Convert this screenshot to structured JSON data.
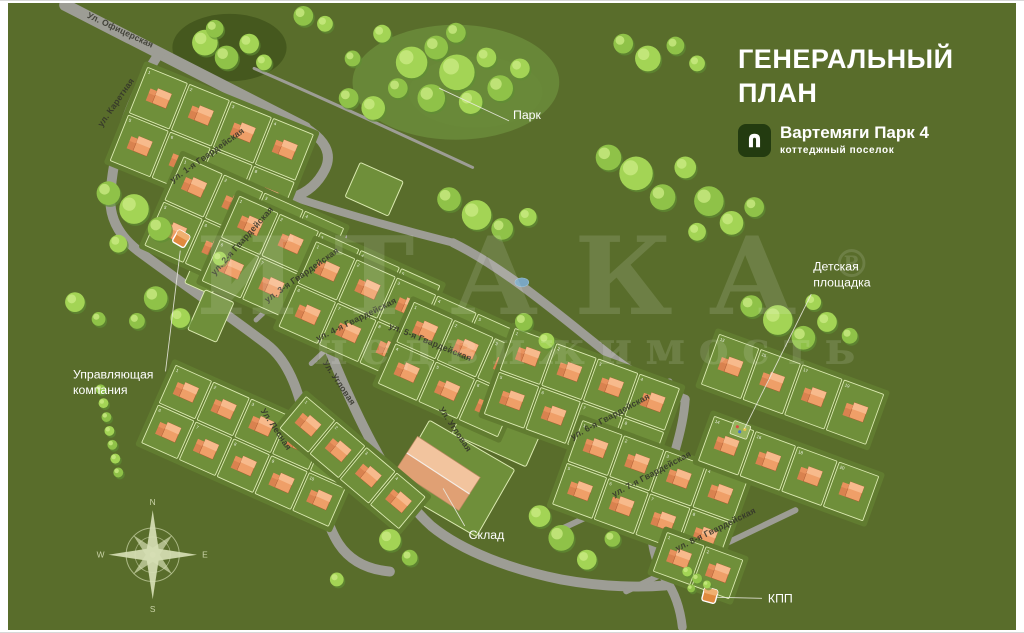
{
  "title": {
    "line1": "ГЕНЕРАЛЬНЫЙ",
    "line2": "ПЛАН"
  },
  "brand": {
    "name": "Вартемяги Парк 4",
    "subtitle": "коттеджный поселок",
    "logo_icon": "house-icon"
  },
  "watermark": {
    "line1": "ИТАКА",
    "reg": "®",
    "line2": "недвижимость"
  },
  "colors": {
    "bg": "#596d2b",
    "plate": "#617c30",
    "parcel": "#6f8f3a",
    "parcelStroke": "#dcebb2",
    "road": "#9d9d95",
    "houseBody": "#ef9f68",
    "houseWing": "#d9824f",
    "houseTop": "#f7ba8c",
    "wingTop": "#e8925d",
    "houseOutline": "#a5542e",
    "treeDark": "#5f8f33",
    "tree1": "#8fc248",
    "tree2": "#a3d455",
    "treeHi": "#c9ea82",
    "label": "#33332a",
    "callout": "#ffffff",
    "leader": "#e9e9df",
    "compass": "#d6deb4",
    "parkPatch": "#69893a",
    "darkPatch": "#42551d",
    "pond": "#7aa6c2",
    "marker": "#e08a3f",
    "warehouseFront": "#f2c49e",
    "warehouseBack": "#e0a074"
  },
  "map": {
    "patches": [
      [
        225,
        45,
        58,
        34,
        "dark"
      ],
      [
        455,
        80,
        105,
        58,
        "park"
      ],
      [
        475,
        90,
        68,
        36,
        "park"
      ]
    ],
    "roads": [
      {
        "d": "M58,2 L302,126",
        "w": 12
      },
      {
        "d": "M302,126 C322,138 330,152 322,168 C314,184 302,192 290,196",
        "w": 10
      },
      {
        "d": "M154,50 C126,92 106,148 104,196 C103,218 114,236 132,250 C170,278 222,314 262,344",
        "w": 10
      },
      {
        "d": "M262,344 C292,366 300,410 310,462 C316,498 324,528 336,546 C348,564 366,572 388,574",
        "w": 10
      },
      {
        "d": "M290,196 C340,212 396,228 452,242",
        "w": 8
      },
      {
        "d": "M452,242 C505,268 560,315 612,356 C646,382 668,392 688,400",
        "w": 9
      },
      {
        "d": "M688,400 C686,432 672,472 658,508 C650,532 654,558 668,582 C678,596 683,612 685,630",
        "w": 9
      },
      {
        "d": "M290,196 C288,228 292,262 306,296 C318,330 344,398 374,452 C392,486 410,510 430,528 C462,554 512,572 562,582 C606,590 644,590 668,588",
        "w": 10
      },
      {
        "d": "M162,192 L258,118",
        "w": 7
      },
      {
        "d": "M252,320 L342,236",
        "w": 5
      },
      {
        "d": "M308,364 L400,278",
        "w": 5
      },
      {
        "d": "M500,452 L672,382",
        "w": 6
      },
      {
        "d": "M560,532 L732,452",
        "w": 6
      },
      {
        "d": "M628,594 L800,512",
        "w": 6
      },
      {
        "d": "M250,66 C320,96 420,142 472,166",
        "w": 3
      }
    ],
    "blocks": [
      {
        "id": "A",
        "cx": 207,
        "cy": 146,
        "rot": 22,
        "nx": 4,
        "ny": 2,
        "cw": 46,
        "ch": 52
      },
      {
        "id": "B",
        "cx": 240,
        "cy": 236,
        "rot": 24,
        "nx": 4,
        "ny": 2,
        "cw": 45,
        "ch": 50
      },
      {
        "id": "C",
        "cx": 318,
        "cy": 283,
        "rot": 24,
        "nx": 5,
        "ny": 2,
        "cw": 45,
        "ch": 48
      },
      {
        "id": "D",
        "cx": 396,
        "cy": 329,
        "rot": 24,
        "nx": 5,
        "ny": 2,
        "cw": 45,
        "ch": 48
      },
      {
        "id": "D2",
        "cx": 455,
        "cy": 370,
        "rot": 24,
        "nx": 3,
        "ny": 2,
        "cw": 45,
        "ch": 46
      },
      {
        "id": "E",
        "cx": 248,
        "cy": 447,
        "rot": 24,
        "nx": 5,
        "ny": 2,
        "cw": 42,
        "ch": 44
      },
      {
        "id": "E2",
        "cx": 350,
        "cy": 464,
        "rot": 40,
        "nx": 4,
        "ny": 1,
        "cw": 40,
        "ch": 44
      },
      {
        "id": "F",
        "cx": 583,
        "cy": 402,
        "rot": 20,
        "nx": 4,
        "ny": 2,
        "cw": 45,
        "ch": 47
      },
      {
        "id": "G",
        "cx": 652,
        "cy": 494,
        "rot": 20,
        "nx": 4,
        "ny": 2,
        "cw": 45,
        "ch": 46
      },
      {
        "id": "FR1",
        "cx": 797,
        "cy": 390,
        "rot": 20,
        "nx": 4,
        "ny": 1,
        "cw": 45,
        "ch": 56,
        "nums": [
          13,
          15,
          17,
          19
        ]
      },
      {
        "id": "FR2",
        "cx": 793,
        "cy": 470,
        "rot": 20,
        "nx": 4,
        "ny": 1,
        "cw": 45,
        "ch": 50,
        "nums": [
          14,
          16,
          18,
          20
        ]
      },
      {
        "id": "BR",
        "cx": 701,
        "cy": 568,
        "rot": 20,
        "nx": 2,
        "ny": 1,
        "cw": 42,
        "ch": 44
      }
    ],
    "empties": [
      {
        "cx": 200,
        "cy": 273,
        "w": 30,
        "h": 34,
        "rot": 24
      },
      {
        "cx": 206,
        "cy": 316,
        "w": 32,
        "h": 44,
        "rot": 24
      },
      {
        "cx": 372,
        "cy": 188,
        "w": 48,
        "h": 38,
        "rot": 24
      },
      {
        "cx": 500,
        "cy": 426,
        "w": 82,
        "h": 56,
        "rot": 24
      },
      {
        "cx": 452,
        "cy": 480,
        "w": 100,
        "h": 78,
        "rot": 30
      }
    ],
    "warehouse": {
      "cx": 437,
      "cy": 475,
      "w": 76,
      "h": 40,
      "rot": 33
    },
    "markers": [
      {
        "id": "management-marker",
        "cx": 176,
        "cy": 238,
        "rot": 30
      },
      {
        "id": "kpp-marker",
        "cx": 713,
        "cy": 598,
        "rot": 15
      }
    ],
    "playground": {
      "cx": 744,
      "cy": 431,
      "rot": 20
    },
    "pond": {
      "cx": 522,
      "cy": 282,
      "rx": 7,
      "ry": 4.5
    },
    "streets": [
      {
        "t": "Ул. Офицерская",
        "x": 113,
        "y": 30,
        "r": 25
      },
      {
        "t": "ул. Каретная",
        "x": 112,
        "y": 102,
        "r": -55
      },
      {
        "t": "ул. 1-я Гвардейская",
        "x": 204,
        "y": 156,
        "r": -35
      },
      {
        "t": "ул. 2-я Гвардейская",
        "x": 240,
        "y": 242,
        "r": -48
      },
      {
        "t": "ул. 3-я Гвардейская",
        "x": 300,
        "y": 277,
        "r": -35
      },
      {
        "t": "ул. 4-я Гвардейская",
        "x": 355,
        "y": 322,
        "r": -26
      },
      {
        "t": "ул. 5-я Гвардейская",
        "x": 428,
        "y": 345,
        "r": 22
      },
      {
        "t": "ул. 6-я Гвардейская",
        "x": 613,
        "y": 420,
        "r": -28
      },
      {
        "t": "ул. 7-я Гвардейская",
        "x": 655,
        "y": 478,
        "r": -28
      },
      {
        "t": "ул. 8-я Гвардейская",
        "x": 720,
        "y": 534,
        "r": -26
      },
      {
        "t": "Ул. Угловая",
        "x": 334,
        "y": 385,
        "r": 56
      },
      {
        "t": "Ул. Угловая",
        "x": 452,
        "y": 432,
        "r": 56
      },
      {
        "t": "Ул. Лесная",
        "x": 270,
        "y": 432,
        "r": 56
      }
    ],
    "callouts": [
      {
        "id": "park",
        "lines": [
          "Парк"
        ],
        "x": 513,
        "y": 117,
        "leader": "M509,119 L438,86"
      },
      {
        "id": "playground",
        "lines": [
          "Детская",
          "площадка"
        ],
        "x": 818,
        "y": 270,
        "leader": "M816,294 L748,430"
      },
      {
        "id": "management",
        "lines": [
          "Управляющая",
          "компания"
        ],
        "x": 66,
        "y": 379,
        "leader": "M160,372 L175,250"
      },
      {
        "id": "sklad",
        "lines": [
          "Склад"
        ],
        "x": 468,
        "y": 541,
        "leader": "M464,528 L442,490"
      },
      {
        "id": "kpp",
        "lines": [
          "КПП"
        ],
        "x": 772,
        "y": 605,
        "leader": "M766,601 L720,600"
      }
    ],
    "compass": {
      "cx": 147,
      "cy": 557,
      "letters": {
        "n": "N",
        "e": "E",
        "s": "S",
        "w": "W"
      }
    },
    "trees": [
      [
        410,
        60,
        16
      ],
      [
        435,
        45,
        12
      ],
      [
        456,
        70,
        18
      ],
      [
        430,
        96,
        14
      ],
      [
        470,
        100,
        12
      ],
      [
        455,
        30,
        10
      ],
      [
        486,
        55,
        10
      ],
      [
        500,
        86,
        13
      ],
      [
        520,
        66,
        10
      ],
      [
        396,
        86,
        10
      ],
      [
        371,
        106,
        12
      ],
      [
        346,
        96,
        10
      ],
      [
        200,
        40,
        13
      ],
      [
        222,
        55,
        12
      ],
      [
        245,
        41,
        10
      ],
      [
        210,
        26,
        9
      ],
      [
        260,
        60,
        8
      ],
      [
        300,
        13,
        10
      ],
      [
        322,
        21,
        8
      ],
      [
        350,
        56,
        8
      ],
      [
        380,
        31,
        9
      ],
      [
        625,
        41,
        10
      ],
      [
        650,
        56,
        13
      ],
      [
        678,
        43,
        9
      ],
      [
        700,
        61,
        8
      ],
      [
        610,
        156,
        13
      ],
      [
        638,
        172,
        17
      ],
      [
        665,
        196,
        13
      ],
      [
        688,
        166,
        11
      ],
      [
        712,
        200,
        15
      ],
      [
        735,
        222,
        12
      ],
      [
        758,
        206,
        10
      ],
      [
        700,
        231,
        9
      ],
      [
        755,
        306,
        11
      ],
      [
        782,
        320,
        15
      ],
      [
        808,
        338,
        12
      ],
      [
        832,
        322,
        10
      ],
      [
        855,
        336,
        8
      ],
      [
        818,
        302,
        8
      ],
      [
        448,
        198,
        12
      ],
      [
        476,
        214,
        15
      ],
      [
        502,
        228,
        11
      ],
      [
        528,
        216,
        9
      ],
      [
        524,
        322,
        9
      ],
      [
        547,
        341,
        8
      ],
      [
        102,
        192,
        12
      ],
      [
        128,
        208,
        15
      ],
      [
        154,
        228,
        12
      ],
      [
        112,
        243,
        9
      ],
      [
        150,
        298,
        12
      ],
      [
        175,
        318,
        10
      ],
      [
        131,
        321,
        8
      ],
      [
        68,
        302,
        10
      ],
      [
        92,
        319,
        7
      ],
      [
        388,
        542,
        11
      ],
      [
        408,
        560,
        8
      ],
      [
        540,
        518,
        11
      ],
      [
        562,
        540,
        13
      ],
      [
        588,
        562,
        10
      ],
      [
        614,
        541,
        8
      ],
      [
        334,
        582,
        7
      ],
      [
        94,
        390,
        5
      ],
      [
        97,
        404,
        5
      ],
      [
        100,
        418,
        5
      ],
      [
        103,
        432,
        5
      ],
      [
        106,
        446,
        5
      ],
      [
        109,
        460,
        5
      ],
      [
        112,
        474,
        5
      ],
      [
        690,
        574,
        5
      ],
      [
        700,
        581,
        5
      ],
      [
        710,
        587,
        4
      ],
      [
        694,
        591,
        4
      ],
      [
        215,
        258,
        7
      ]
    ]
  }
}
